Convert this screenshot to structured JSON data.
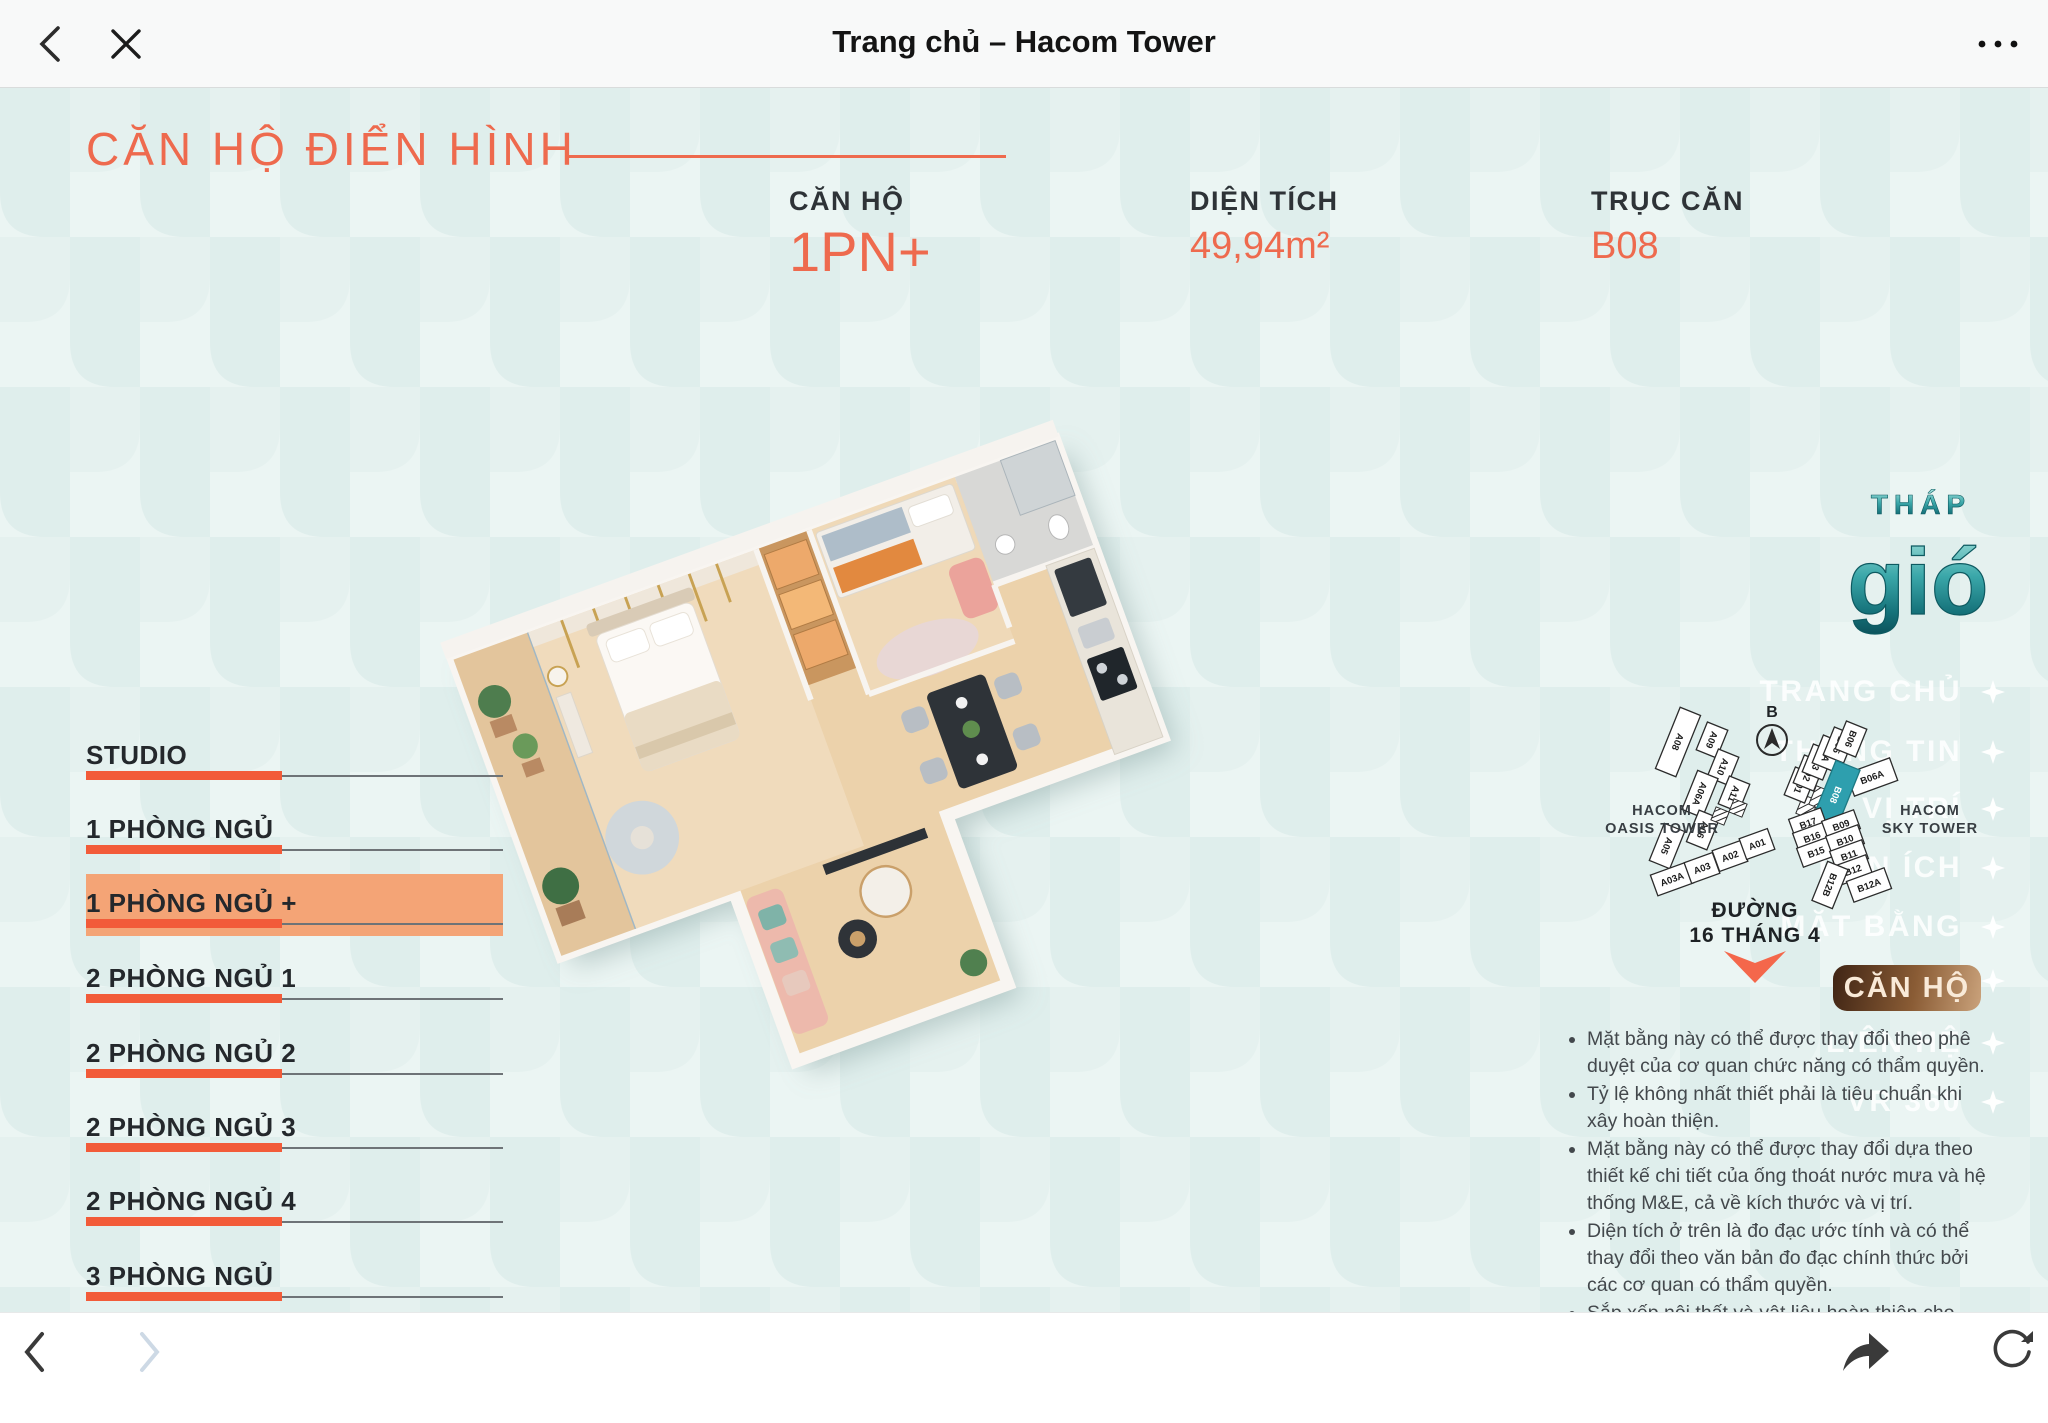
{
  "titlebar": {
    "title": "Trang chủ – Hacom Tower"
  },
  "hero": {
    "section_title": "CĂN HỘ ĐIỂN HÌNH",
    "specs": [
      {
        "label": "CĂN HỘ",
        "value": "1PN+"
      },
      {
        "label": "DIỆN TÍCH",
        "value": "49,94m²"
      },
      {
        "label": "TRỤC CĂN",
        "value": "B08"
      }
    ]
  },
  "unit_menu": {
    "selected_index": 2,
    "items": [
      {
        "label": "STUDIO"
      },
      {
        "label": "1 PHÒNG NGỦ"
      },
      {
        "label": "1 PHÒNG NGỦ +"
      },
      {
        "label": "2 PHÒNG NGỦ 1"
      },
      {
        "label": "2 PHÒNG NGỦ 2"
      },
      {
        "label": "2 PHÒNG NGỦ 3"
      },
      {
        "label": "2 PHÒNG NGỦ 4"
      },
      {
        "label": "3 PHÒNG NGỦ"
      }
    ]
  },
  "tower_logo": {
    "top": "THÁP",
    "main": "gió"
  },
  "side_nav": {
    "items": [
      "TRANG CHỦ",
      "THÔNG TIN",
      "VỊ TRÍ",
      "TIỆN ÍCH",
      "MẶT BẰNG",
      "LIÊN HỆ",
      "VR 360"
    ],
    "cta": "CĂN HỘ"
  },
  "minimap": {
    "compass": "B",
    "street_line1": "ĐƯỜNG",
    "street_line2": "16 THÁNG 4",
    "oasis": {
      "name1": "HACOM",
      "name2": "OASIS TOWER",
      "units": [
        "A08",
        "A09",
        "A10",
        "A11",
        "A06A",
        "A06",
        "A05",
        "A03A",
        "A03",
        "A02",
        "A01"
      ]
    },
    "sky": {
      "name1": "HACOM",
      "name2": "SKY TOWER",
      "units": [
        "B01",
        "B02",
        "B03",
        "B3A",
        "B05",
        "B06",
        "B06A",
        "B08",
        "B17",
        "B16",
        "B15",
        "B09",
        "B10",
        "B11",
        "B12",
        "B12B",
        "B12A"
      ],
      "highlighted_unit": "B08"
    }
  },
  "disclaimers": [
    "Mặt bằng này có thể được thay đổi theo phê duyệt của cơ quan chức năng có thẩm quyền.",
    "Tỷ lệ không nhất thiết phải là tiêu chuẩn khi xây hoàn thiện.",
    "Mặt bằng này có thể được thay đổi dựa theo thiết kế chi tiết của ống thoát nước mưa và hệ thống M&E, cả về kích thước và vị trí.",
    "Diện tích ở trên là đo đạc ước tính và có thể thay đổi theo văn bản đo đạc chính thức bởi các cơ quan có thẩm quyền.",
    "Sắp xếp nội thất và vật liệu hoàn thiện cho mục đích tham khảo. Vui lòng sử dụng tài liệu đặc điểm kĩ thuật đính kèm trong hợp đồng mua bán để biết"
  ],
  "colors": {
    "accent_orange": "#ee6a4e",
    "bar_orange": "#f25b39",
    "selected_bg": "#f4a476",
    "teal_highlight": "#2e9fae",
    "cta_gradient_from": "#3f2414",
    "cta_gradient_to": "#caa27b",
    "bg_tile_light": "#ebf5f3",
    "bg_tile_dark": "#dfeeec"
  },
  "icons": {
    "back": "chevron-left",
    "close": "x",
    "more": "ellipsis",
    "forward": "chevron-right",
    "share": "share-arrow",
    "reload": "refresh",
    "nav_bullet": "four-point-star",
    "compass": "north-arrow"
  }
}
